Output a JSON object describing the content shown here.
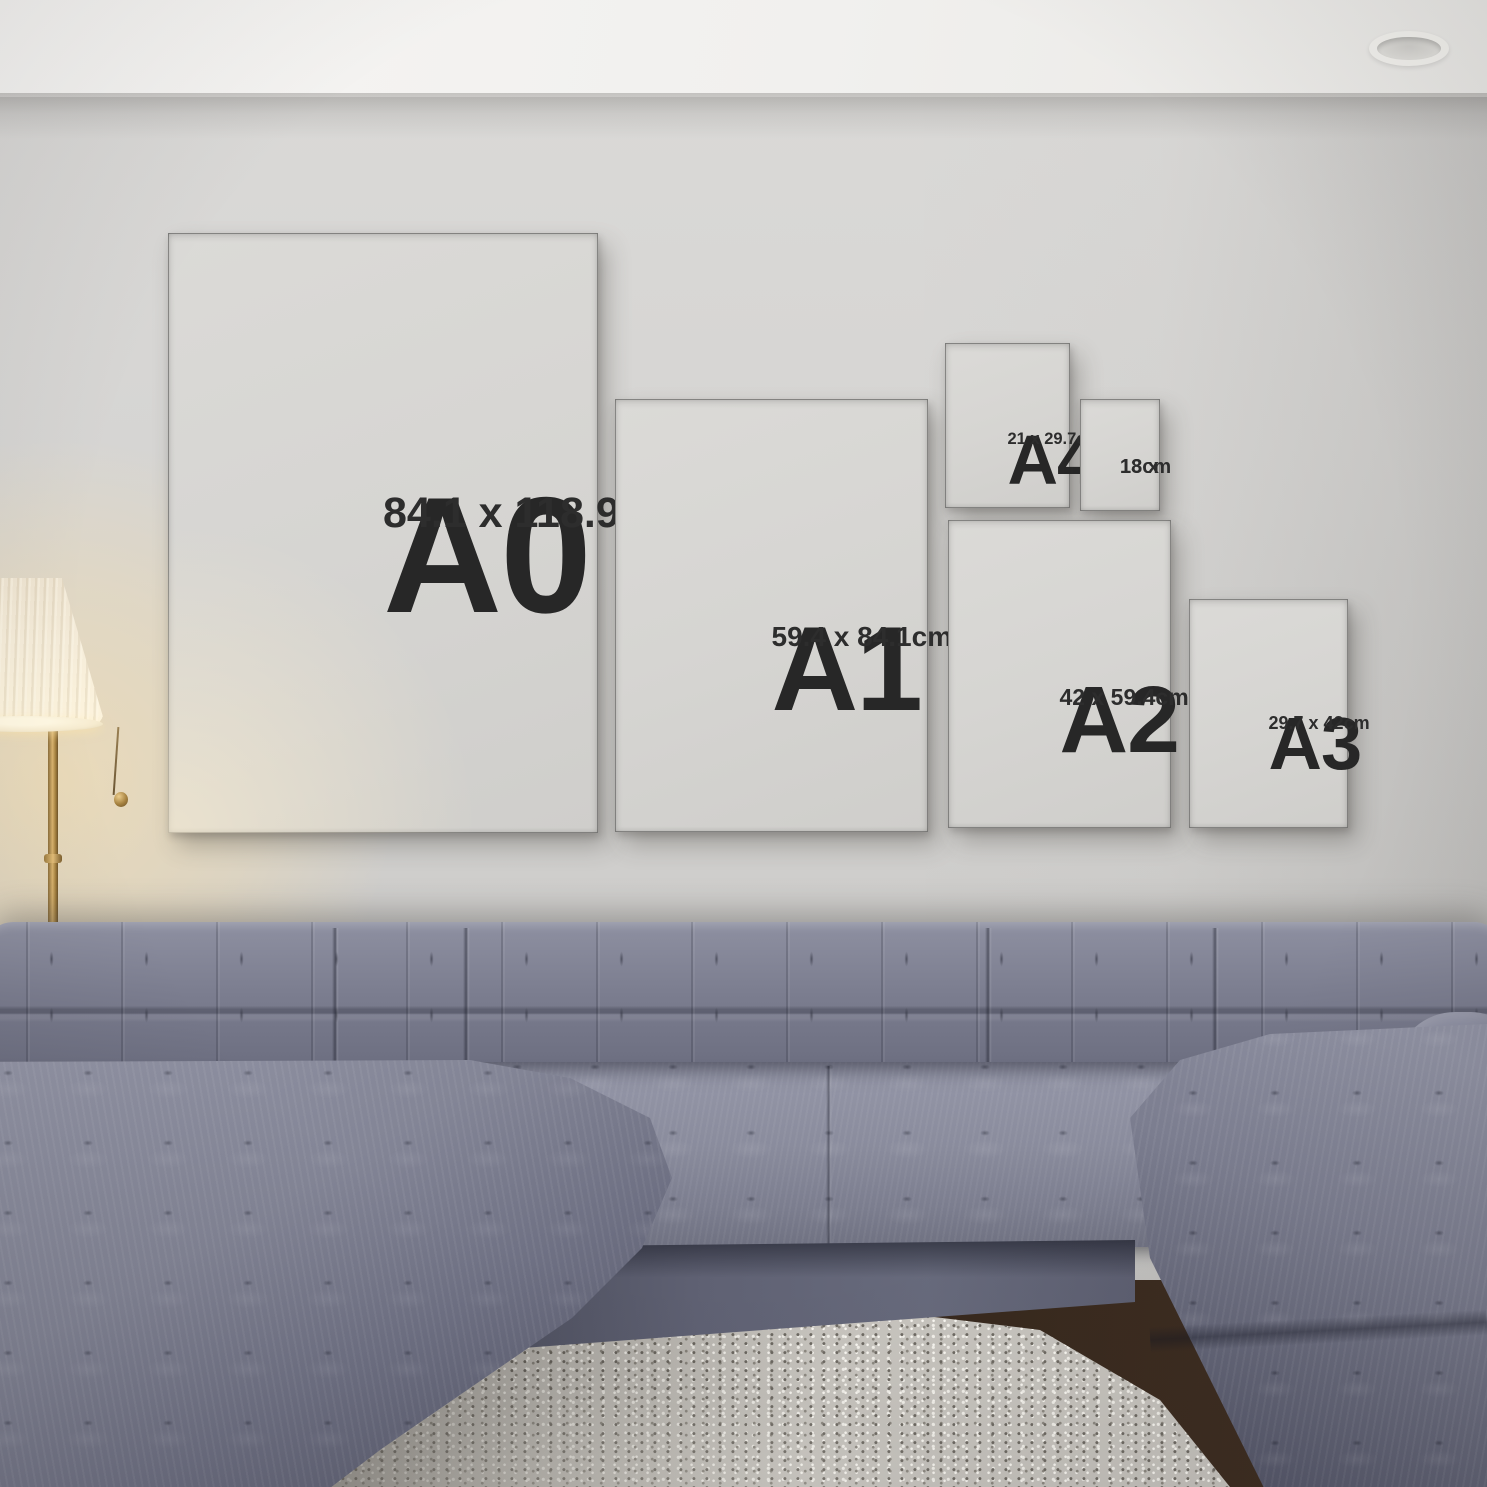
{
  "frames": [
    {
      "id": "a0",
      "label": "A0",
      "size": "84.1 x 118.9cm"
    },
    {
      "id": "a1",
      "label": "A1",
      "size": "59.4 x 84.1cm"
    },
    {
      "id": "a4",
      "label": "A4",
      "size": "21 x 29.7cm"
    },
    {
      "id": "13x18",
      "label": "",
      "size_lines": [
        "13 x",
        "18cm"
      ]
    },
    {
      "id": "a2",
      "label": "A2",
      "size": "42 x 59.4cm"
    },
    {
      "id": "a3",
      "label": "A3",
      "size": "29.7 x 42cm"
    }
  ],
  "palette": {
    "frame_black": "#161616",
    "poster_paper": "#d6d5d2",
    "poster_text": "#2b2b2b",
    "wall": "#d2d1cf",
    "ceiling": "#f3f2f0",
    "sofa_fabric": "#7b7d8f",
    "rug": "#c8c5bf",
    "floor": "#33261c",
    "lamp_shade": "#f4ecda",
    "lamp_glow": "#ffe3ad",
    "lamp_brass": "#b08d52"
  }
}
